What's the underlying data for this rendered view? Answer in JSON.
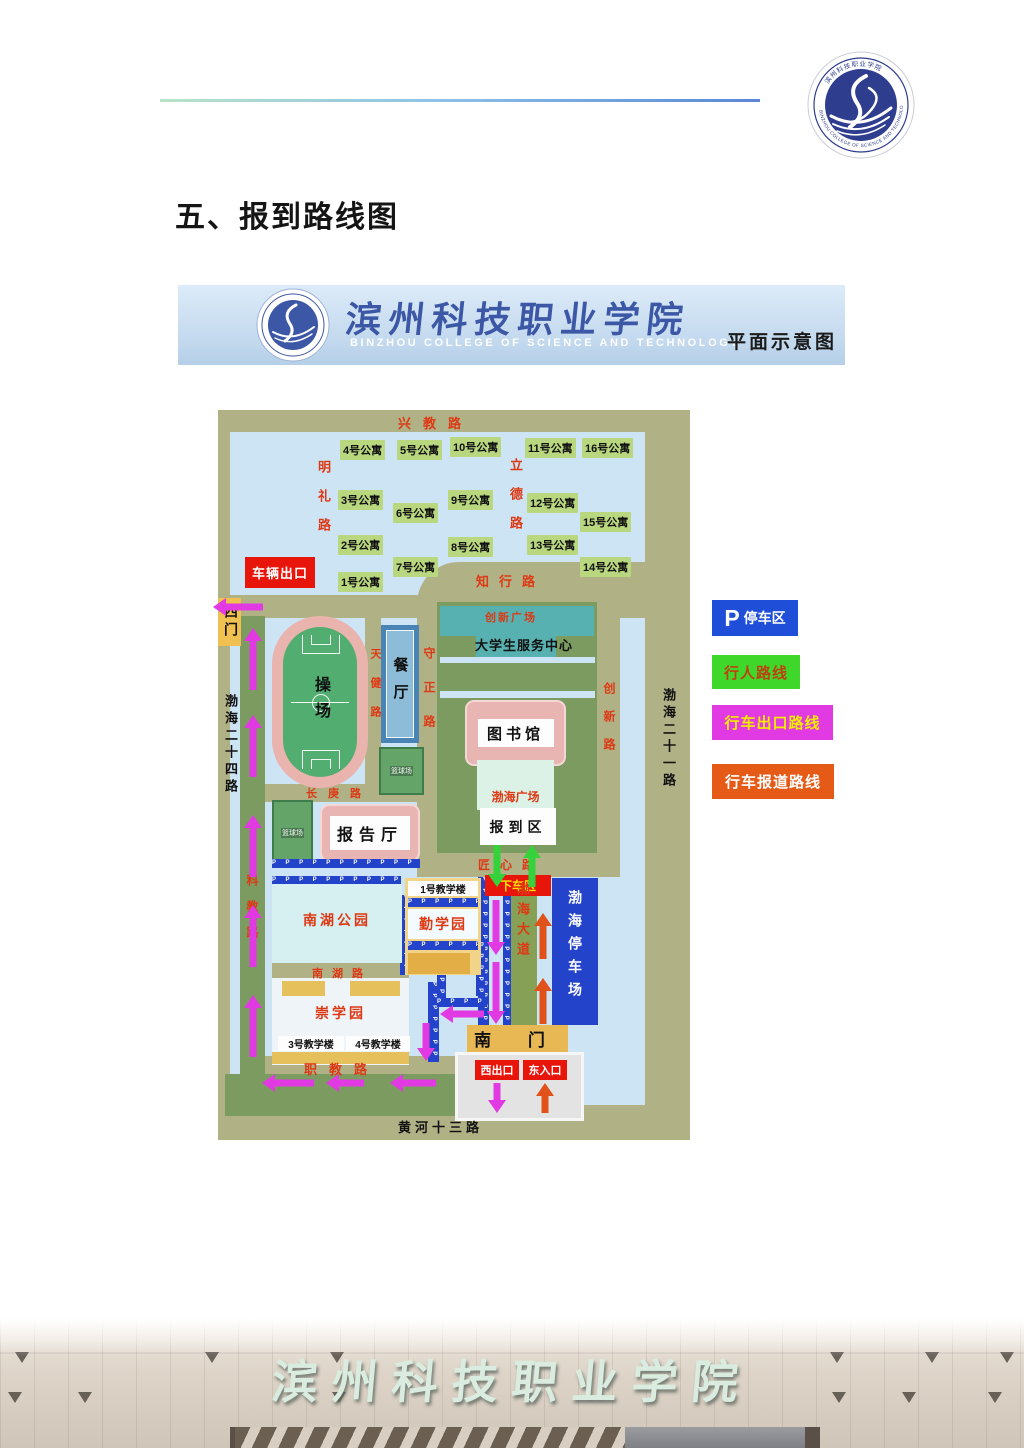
{
  "page": {
    "title": "五、报到路线图"
  },
  "banner": {
    "college_cn": "滨州科技职业学院",
    "college_en": "BINZHOU COLLEGE OF SCIENCE AND TECHNOLOGY",
    "caption": "平面示意图"
  },
  "emblem": {
    "ring_text_en": "BINZHOU COLLEGE OF SCIENCE AND TECHNOLOGY",
    "ring_text_cn": "滨州科技职业学院"
  },
  "map": {
    "roads": {
      "xingjiao": "兴教路",
      "mingli": "明礼路",
      "lide": "立德路",
      "zhixing": "知行路",
      "tianjian": "天健路",
      "shouzheng": "守正路",
      "changgeng": "长庚路",
      "chuangxin": "创新路",
      "jiangxin": "匠心路",
      "bohai_dadao": "渤海大道",
      "kejiao": "科教路",
      "nanhu_lu": "南湖路",
      "zhijiao": "职教路",
      "huanghe13": "黄河十三路",
      "bohai24": "渤海二十四路",
      "bohai21": "渤海二十一路"
    },
    "dorms": [
      "1号公寓",
      "2号公寓",
      "3号公寓",
      "4号公寓",
      "5号公寓",
      "6号公寓",
      "7号公寓",
      "8号公寓",
      "9号公寓",
      "10号公寓",
      "11号公寓",
      "12号公寓",
      "13号公寓",
      "14号公寓",
      "15号公寓",
      "16号公寓"
    ],
    "labels": {
      "vehicle_exit": "车辆出口",
      "west_gate": "西门",
      "playground": "操场",
      "canteen": "餐厅",
      "basketball": "篮球场",
      "innovation_plaza": "创新广场",
      "student_center": "大学生服务中心",
      "library": "图书馆",
      "bohai_plaza": "渤海广场",
      "registration_area": "报到区",
      "dropoff_area": "下车区",
      "lecture_hall": "报告厅",
      "nanhu_park": "南湖公园",
      "teach1": "1号教学楼",
      "qinxueyuan": "勤学园",
      "chongxueyuan": "崇学园",
      "teach3": "3号教学楼",
      "teach4": "4号教学楼",
      "bohai_parking": "渤海停车场",
      "south_gate": "南 门",
      "west_exit": "西出口",
      "east_entrance": "东入口",
      "p_strip": "P P P P P P P P P P P P P P P P"
    },
    "legend": [
      {
        "icon": "P",
        "label": "停车区",
        "bg": "#1f4fd8",
        "fg": "#ffffff"
      },
      {
        "label": "行人路线",
        "bg": "#3fd82a",
        "fg": "#bf4010"
      },
      {
        "label": "行车出口路线",
        "bg": "#e23ae2",
        "fg": "#f2ee00"
      },
      {
        "label": "行车报道路线",
        "bg": "#e55a17",
        "fg": "#ffffff"
      }
    ],
    "route_colors": {
      "pedestrian": "#35d23c",
      "vehicle_exit": "#e23ae2",
      "vehicle_report": "#e0521a"
    }
  },
  "photo": {
    "gate_name": "滨州科技职业学院"
  }
}
